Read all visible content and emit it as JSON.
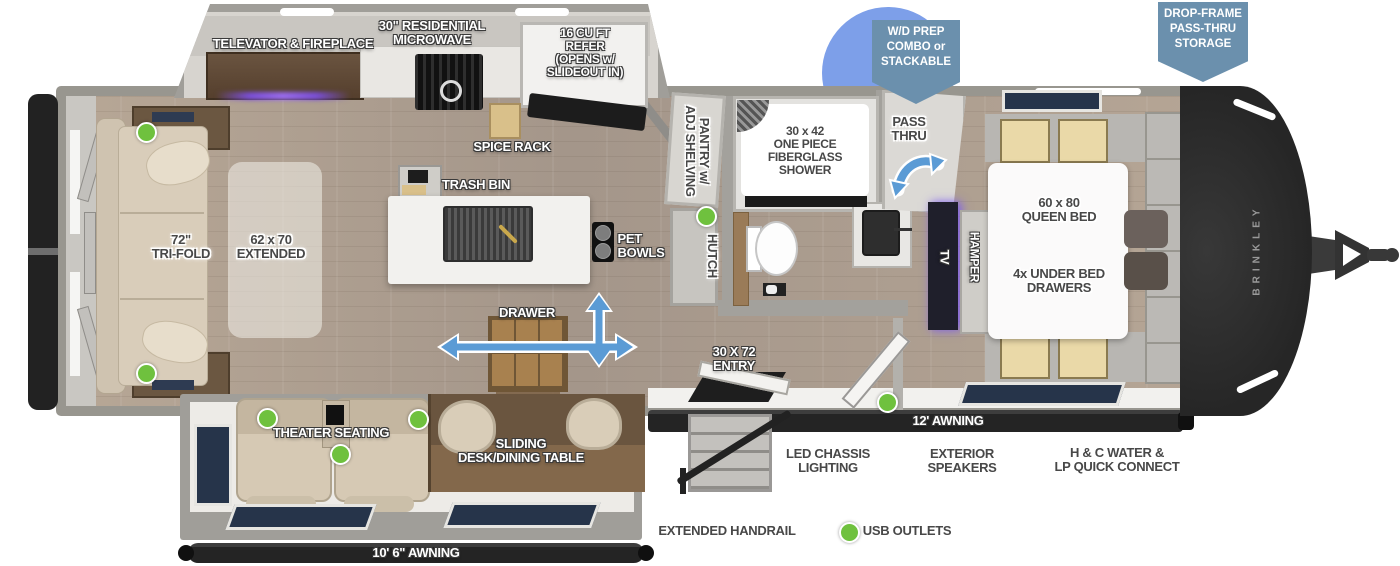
{
  "plan": {
    "brand": "BRINKLEY",
    "callouts": {
      "wd_prep": "W/D PREP\nCOMBO or\nSTACKABLE",
      "drop_frame": "DROP-FRAME\nPASS-THRU\nSTORAGE"
    },
    "labels": {
      "televator_fireplace": "TELEVATOR & FIREPLACE",
      "residential_microwave": "30\" RESIDENTIAL\nMICROWAVE",
      "refer": "16 CU FT\nREFER\n(OPENS w/\nSLIDEOUT IN)",
      "spice_rack": "SPICE RACK",
      "trash_bin": "TRASH BIN",
      "tri_fold": "72\"\nTRI-FOLD",
      "extended": "62 x 70\nEXTENDED",
      "pantry": "PANTRY w/\nADJ SHELVING",
      "shower": "30 x 42\nONE PIECE\nFIBERGLASS\nSHOWER",
      "pass_thru": "PASS\nTHRU",
      "hutch": "HUTCH",
      "pet_bowls": "PET\nBOWLS",
      "tv": "TV",
      "hamper": "HAMPER",
      "queen_bed": "60 x 80\nQUEEN BED",
      "under_bed_drawers": "4x UNDER BED\nDRAWERS",
      "drawer": "DRAWER",
      "entry": "30 X 72\nENTRY",
      "theater_seating": "THEATER SEATING",
      "sliding_desk": "SLIDING\nDESK/DINING TABLE",
      "awning_rear": "10' 6\" AWNING",
      "awning_main": "12' AWNING"
    },
    "features": {
      "led_chassis": "LED CHASSIS\nLIGHTING",
      "exterior_speakers": "EXTERIOR\nSPEAKERS",
      "hc_water": "H & C WATER &\nLP QUICK CONNECT",
      "extended_handrail": "EXTENDED HANDRAIL",
      "usb_outlets": "USB OUTLETS"
    },
    "colors": {
      "badge_blue": "#6b90ad",
      "circle_blue": "#7d9fe9",
      "arrow_blue": "#5b9bd5",
      "usb_green": "#6fc13e",
      "awning_black": "#242424"
    }
  }
}
